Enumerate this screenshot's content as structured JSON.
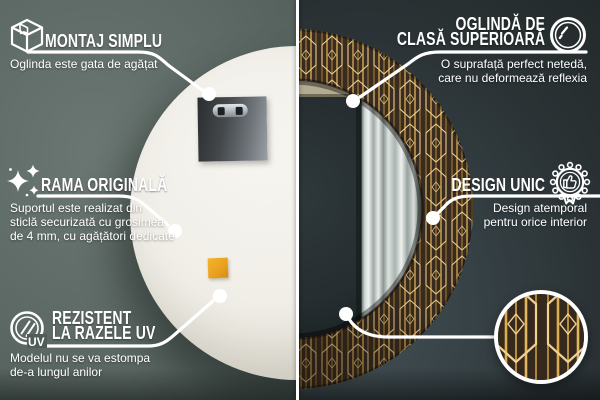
{
  "callouts": {
    "montaj": {
      "icon": "package-box-icon",
      "title": "MONTAJ SIMPLU",
      "desc": "Oglinda este gata de agățat"
    },
    "rama": {
      "icon": "sparkles-icon",
      "title": "RAMA ORIGINALĂ",
      "desc_lines": [
        "Suportul este realizat din",
        "sticlă securizată cu grosimea",
        "de 4 mm, cu agățători dedicate"
      ]
    },
    "uv": {
      "icon": "uv-protection-icon",
      "icon_label": "UV",
      "title_lines": [
        "REZISTENT",
        "LA RAZELE UV"
      ],
      "desc_lines": [
        "Modelul nu se va estompa",
        "de-a lungul anilor"
      ]
    },
    "oglinda": {
      "icon": "mirror-shine-icon",
      "title_lines": [
        "OGLINDĂ DE",
        "CLASĂ SUPERIOARĂ"
      ],
      "desc_lines": [
        "O suprafață perfect netedă,",
        "care nu deformează reflexia"
      ]
    },
    "design": {
      "icon": "award-badge-icon",
      "title": "DESIGN UNIC",
      "desc_lines": [
        "Design atemporal",
        "pentru orice interior"
      ]
    }
  },
  "scene": {
    "left_view": "mirror-back",
    "right_view": "mirror-front",
    "detail_view": "pattern-zoom-circle"
  },
  "colors": {
    "wall_left": "#5d6965",
    "wall_right": "#2b3336",
    "divider": "#ffffff",
    "mirror_back": "#f2efe8",
    "sticker_orange": "#eda21f",
    "frame_background": "#3a2c20",
    "frame_gold": "#dcab52",
    "frame_gold_light": "#f0d190",
    "glass_reflection": "#2c3336",
    "curtain": "#dde3e0",
    "reflection_beige": "#b3ab92",
    "text": "#ffffff"
  }
}
